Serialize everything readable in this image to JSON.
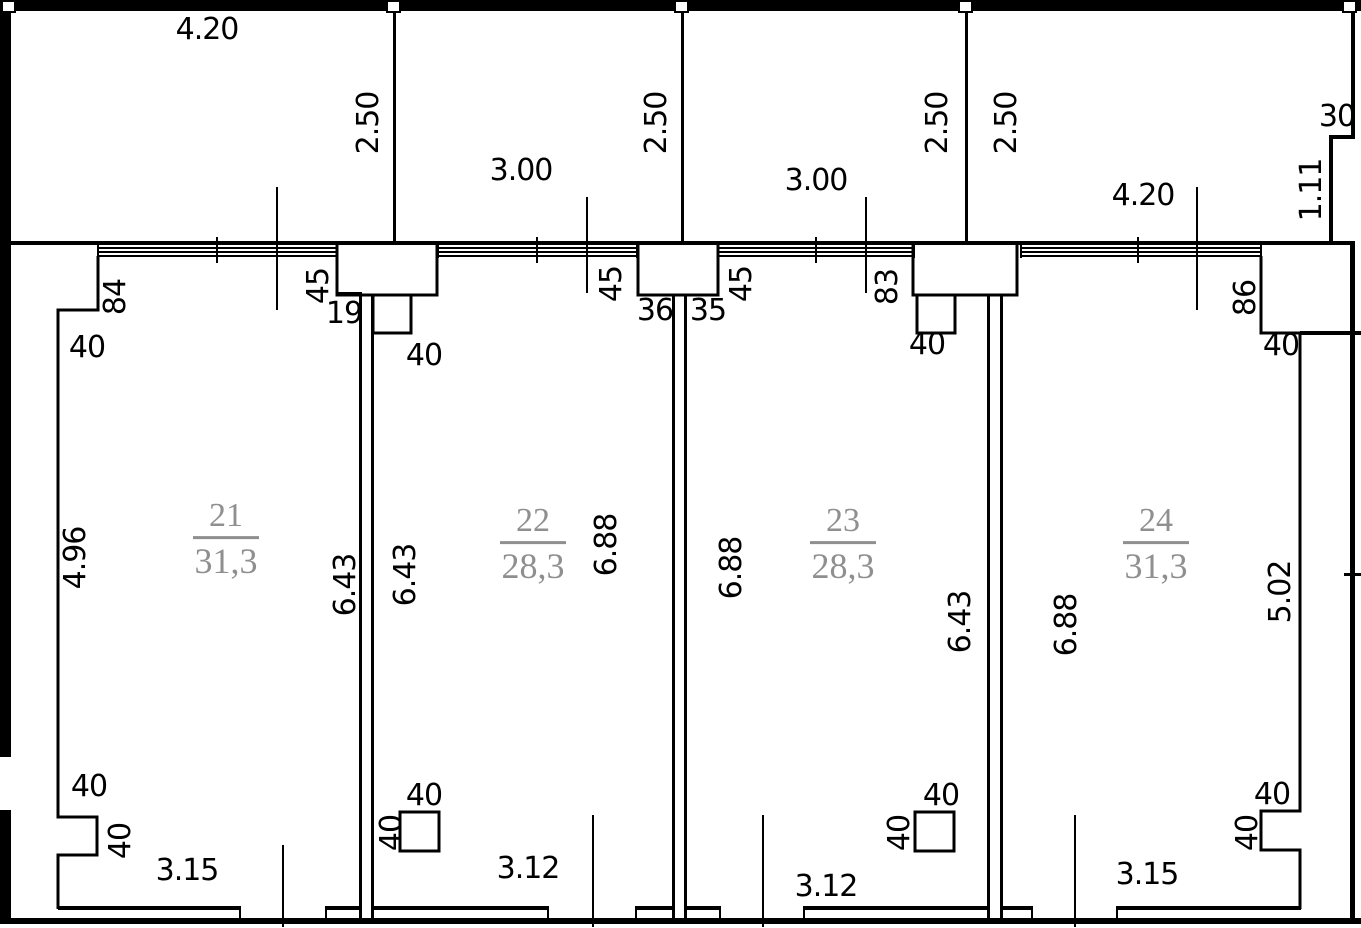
{
  "drawing": {
    "type": "floor-plan",
    "background": "#ffffff",
    "line_color": "#000000",
    "room_label_color": "#8f8f8f"
  },
  "rooms": [
    {
      "number": "21",
      "area": "31,3",
      "x": 226,
      "y": 540
    },
    {
      "number": "22",
      "area": "28,3",
      "x": 533,
      "y": 545
    },
    {
      "number": "23",
      "area": "28,3",
      "x": 843,
      "y": 545
    },
    {
      "number": "24",
      "area": "31,3",
      "x": 1156,
      "y": 545
    }
  ],
  "labels": [
    {
      "text": "4.20",
      "x": 207,
      "y": 30,
      "rot": false
    },
    {
      "text": "3.00",
      "x": 521,
      "y": 171,
      "rot": false
    },
    {
      "text": "3.00",
      "x": 816,
      "y": 181,
      "rot": false
    },
    {
      "text": "4.20",
      "x": 1143,
      "y": 196,
      "rot": false
    },
    {
      "text": "30",
      "x": 1337,
      "y": 117,
      "rot": false
    },
    {
      "text": "2.50",
      "x": 369,
      "y": 123,
      "rot": true
    },
    {
      "text": "2.50",
      "x": 657,
      "y": 123,
      "rot": true
    },
    {
      "text": "2.50",
      "x": 938,
      "y": 123,
      "rot": true
    },
    {
      "text": "2.50",
      "x": 1007,
      "y": 123,
      "rot": true
    },
    {
      "text": "1.11",
      "x": 1312,
      "y": 190,
      "rot": true
    },
    {
      "text": "84",
      "x": 116,
      "y": 297,
      "rot": true
    },
    {
      "text": "45",
      "x": 319,
      "y": 286,
      "rot": true
    },
    {
      "text": "19",
      "x": 344,
      "y": 314,
      "rot": false
    },
    {
      "text": "40",
      "x": 87,
      "y": 348,
      "rot": false
    },
    {
      "text": "40",
      "x": 424,
      "y": 356,
      "rot": false
    },
    {
      "text": "45",
      "x": 612,
      "y": 284,
      "rot": true
    },
    {
      "text": "36",
      "x": 655,
      "y": 311,
      "rot": false
    },
    {
      "text": "35",
      "x": 708,
      "y": 311,
      "rot": false
    },
    {
      "text": "45",
      "x": 742,
      "y": 284,
      "rot": true
    },
    {
      "text": "83",
      "x": 888,
      "y": 287,
      "rot": true
    },
    {
      "text": "40",
      "x": 927,
      "y": 345,
      "rot": false
    },
    {
      "text": "86",
      "x": 1246,
      "y": 298,
      "rot": true
    },
    {
      "text": "40",
      "x": 1281,
      "y": 346,
      "rot": false
    },
    {
      "text": "4.96",
      "x": 76,
      "y": 558,
      "rot": true
    },
    {
      "text": "6.43",
      "x": 346,
      "y": 585,
      "rot": true
    },
    {
      "text": "6.43",
      "x": 406,
      "y": 575,
      "rot": true
    },
    {
      "text": "6.88",
      "x": 607,
      "y": 545,
      "rot": true
    },
    {
      "text": "6.88",
      "x": 732,
      "y": 568,
      "rot": true
    },
    {
      "text": "6.43",
      "x": 961,
      "y": 622,
      "rot": true
    },
    {
      "text": "6.88",
      "x": 1067,
      "y": 625,
      "rot": true
    },
    {
      "text": "5.02",
      "x": 1281,
      "y": 592,
      "rot": true
    },
    {
      "text": "40",
      "x": 89,
      "y": 787,
      "rot": false
    },
    {
      "text": "40",
      "x": 121,
      "y": 841,
      "rot": true
    },
    {
      "text": "40",
      "x": 424,
      "y": 796,
      "rot": false
    },
    {
      "text": "40",
      "x": 392,
      "y": 833,
      "rot": true
    },
    {
      "text": "40",
      "x": 941,
      "y": 796,
      "rot": false
    },
    {
      "text": "40",
      "x": 900,
      "y": 833,
      "rot": true
    },
    {
      "text": "40",
      "x": 1272,
      "y": 795,
      "rot": false
    },
    {
      "text": "40",
      "x": 1248,
      "y": 833,
      "rot": true
    },
    {
      "text": "3.15",
      "x": 187,
      "y": 871,
      "rot": false
    },
    {
      "text": "3.12",
      "x": 528,
      "y": 869,
      "rot": false
    },
    {
      "text": "3.12",
      "x": 826,
      "y": 887,
      "rot": false
    },
    {
      "text": "3.15",
      "x": 1147,
      "y": 875,
      "rot": false
    }
  ]
}
